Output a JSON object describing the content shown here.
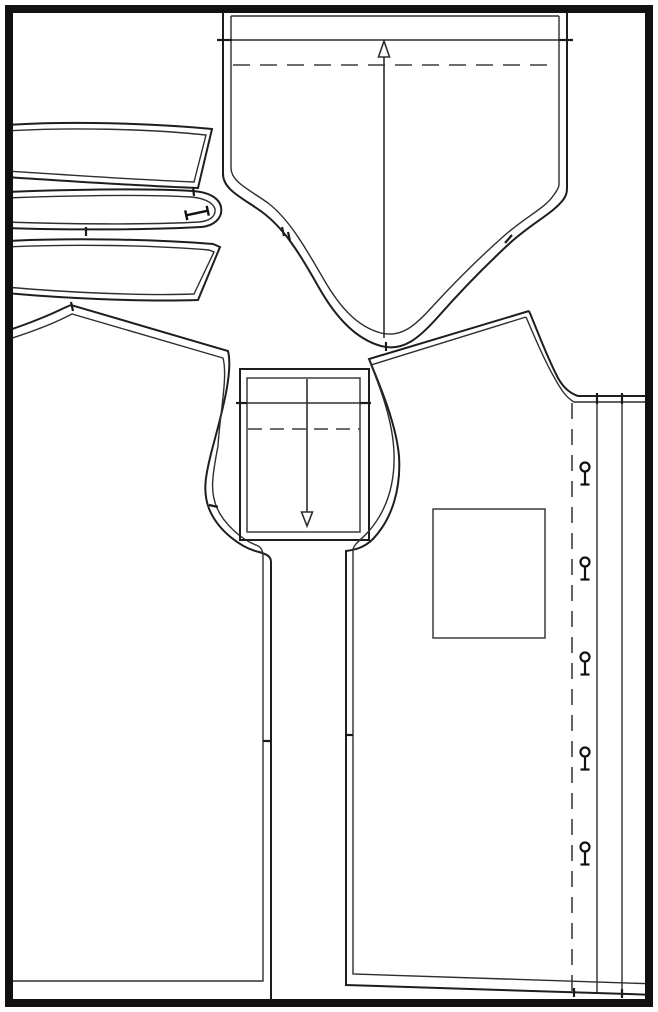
{
  "page": {
    "title": "sewing-pattern-sheet",
    "background": "#ffffff"
  },
  "colors": {
    "page_border": "#111111",
    "cut_line": "#1e1e1e",
    "seam_line": "#2e2e2e",
    "dash_line": "#3d3d3d",
    "marker": "#111111"
  },
  "pieces": [
    {
      "name": "back-piece",
      "position": "top-center",
      "features": [
        "fold-dash-line",
        "grainline-arrow-up",
        "edge-notches"
      ]
    },
    {
      "name": "strip-piece-1",
      "position": "upper-left"
    },
    {
      "name": "collar-band-piece",
      "position": "upper-left",
      "features": [
        "buttonhole-bar"
      ]
    },
    {
      "name": "strip-piece-3",
      "position": "upper-left"
    },
    {
      "name": "left-front-piece",
      "position": "left",
      "features": [
        "armhole-notch",
        "side-notch"
      ]
    },
    {
      "name": "cuff-piece",
      "position": "center",
      "features": [
        "fold-dash-line",
        "grainline-arrow-down",
        "edge-notches"
      ]
    },
    {
      "name": "right-front-piece",
      "position": "right",
      "features": [
        "pocket",
        "button-placket",
        "buttonholes"
      ]
    }
  ],
  "markers": {
    "buttonholes": {
      "x": 585,
      "ys": [
        467,
        562,
        657,
        752,
        847
      ],
      "circle_r": 4.5,
      "stem": 13,
      "foot_w": 9
    },
    "collar_buttonhole": {
      "x": 197,
      "y": 213,
      "angle": -12,
      "length": 22,
      "cap": 10
    },
    "grainlines": [
      {
        "name": "back-grainline",
        "x": 384,
        "line_from": 338,
        "line_to": 57,
        "tip_y": 41,
        "dir": "up",
        "half_w": 5.5
      },
      {
        "name": "cuff-grainline",
        "x": 307,
        "line_from": 379,
        "line_to": 512,
        "tip_y": 526,
        "dir": "down",
        "half_w": 5.5
      }
    ]
  }
}
